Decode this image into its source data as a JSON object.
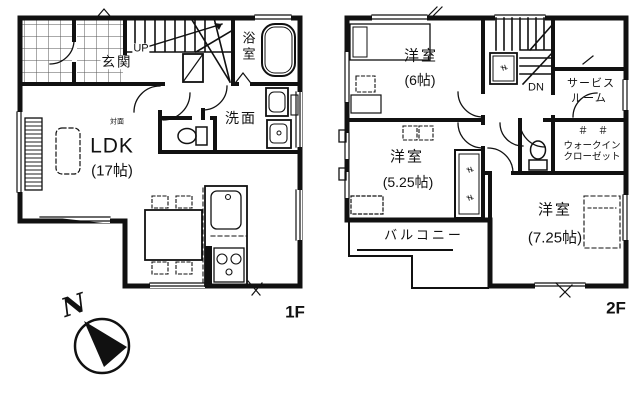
{
  "meta": {
    "floor1_label": "1F",
    "floor2_label": "2F",
    "compass_north": "N"
  },
  "floor1": {
    "entrance": "玄関",
    "stairs_up": "UP",
    "bath": "浴室",
    "washroom": "洗面",
    "ldk_note": "対面",
    "ldk": "LDK",
    "ldk_size": "(17帖)"
  },
  "floor2": {
    "bedroom6": "洋室",
    "bedroom6_size": "(6帖)",
    "stairs_down": "DN",
    "service_room_line1": "サービス",
    "service_room_line2": "ルーム",
    "bedroom525": "洋室",
    "bedroom525_size": "(5.25帖)",
    "wic_line1": "ウォークイン",
    "wic_line2": "クローゼット",
    "bedroom725": "洋室",
    "bedroom725_size": "(7.25帖)",
    "balcony": "バルコニー",
    "hanger_marks": "＃　＃",
    "closet_mark": "≠"
  },
  "colors": {
    "line": "#111111",
    "bg": "#ffffff"
  }
}
